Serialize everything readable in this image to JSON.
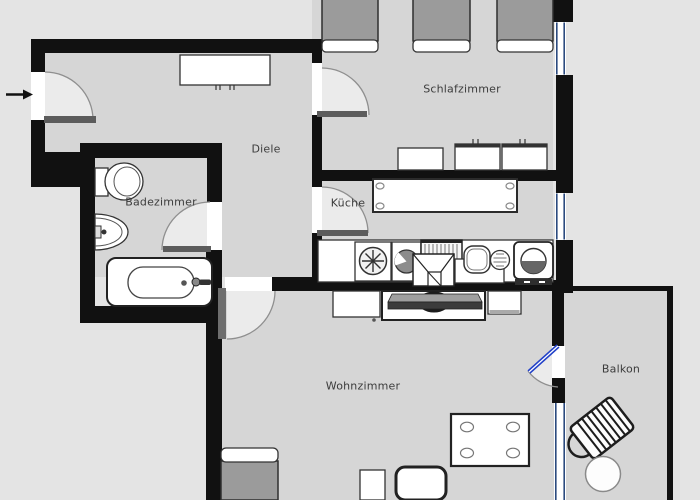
{
  "floorplan": {
    "type": "apartment-floor-plan",
    "rooms": {
      "diele": {
        "label": "Diele"
      },
      "schlafzimmer": {
        "label": "Schlafzimmer"
      },
      "badezimmer": {
        "label": "Badezimmer"
      },
      "kueche": {
        "label": "Küche"
      },
      "wohnzimmer": {
        "label": "Wohnzimmer"
      },
      "balkon": {
        "label": "Balkon"
      }
    },
    "colors": {
      "background": "#e4e4e4",
      "floor": "#d6d6d6",
      "wall": "#111111",
      "window_glass": "#2b4a7e",
      "balcony_door_glass": "#2140c8",
      "furniture_gray": "#9b9b9b",
      "door_leaf": "#5c5c5c",
      "label_text": "#3c3c3c"
    },
    "icons": {
      "entrance_arrow": "arrow-right"
    },
    "furniture": {
      "schlafzimmer": [
        "bed",
        "bed",
        "bed",
        "dresser",
        "cabinet",
        "cabinet"
      ],
      "diele": [
        "wardrobe"
      ],
      "badezimmer": [
        "toilet",
        "sink",
        "bathtub"
      ],
      "kueche": [
        "dining-table",
        "counter",
        "washing-machine",
        "appliance",
        "cooktop",
        "hood-sink",
        "sink-basin",
        "oven"
      ],
      "wohnzimmer": [
        "cabinet",
        "tv-board",
        "tv",
        "sofa",
        "chair",
        "chair",
        "dining-table",
        "cabinet"
      ],
      "balkon": [
        "deck-chair",
        "round-table"
      ]
    },
    "window_count": 3,
    "door_count": 6
  }
}
